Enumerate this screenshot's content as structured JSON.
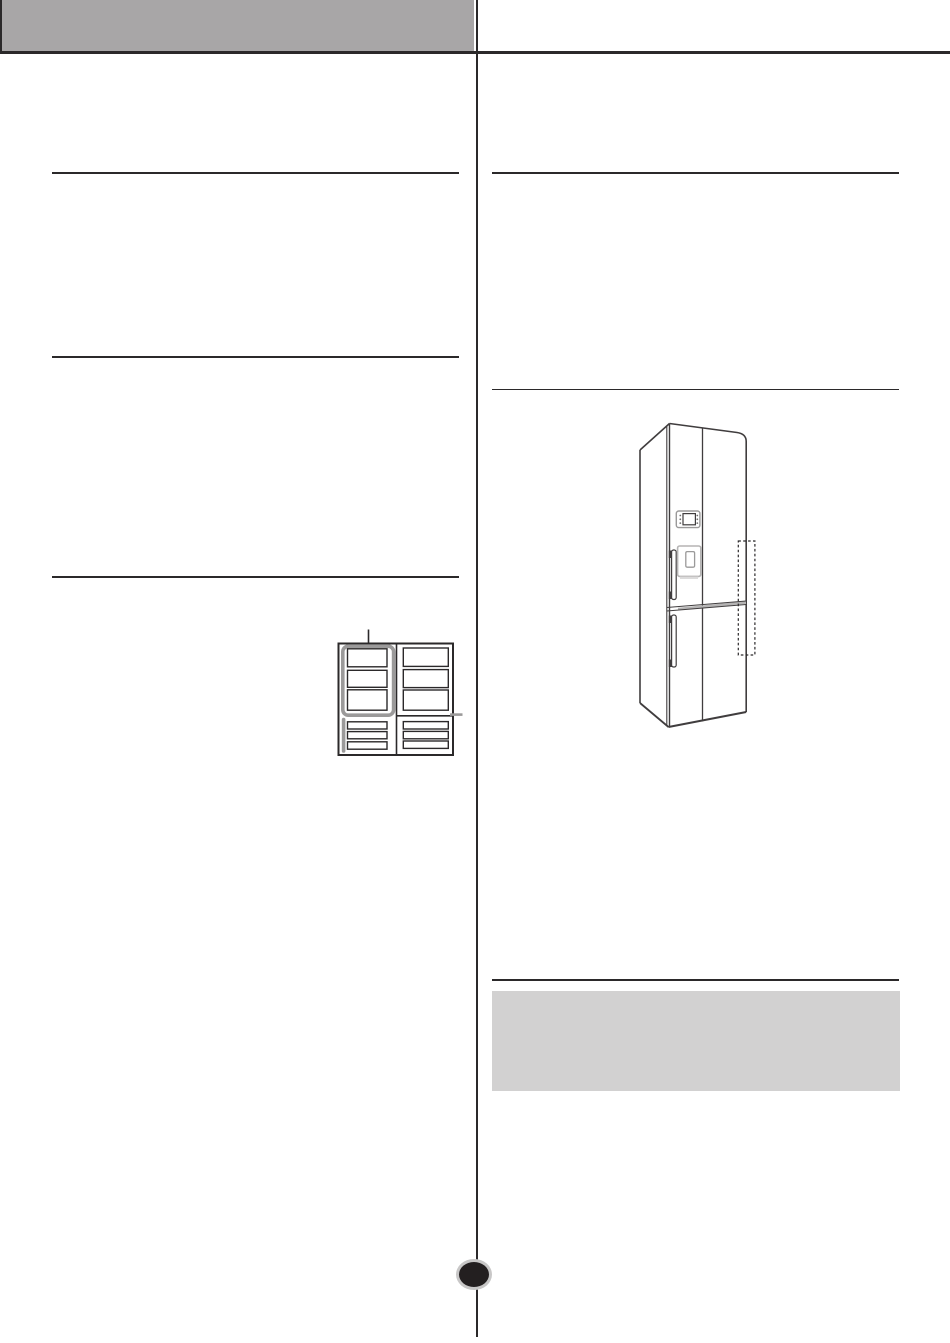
{
  "document": {
    "visible_text": "",
    "description": "scanned manual page, graphics only"
  },
  "colors": {
    "page-bg": "#ffffff",
    "header-bar": "#a8a6a7",
    "rule-dark": "#2b292a",
    "line-art": "#403d3e",
    "line-art-light": "#b5b4b4",
    "highlight-gray": "#9b9a9a",
    "note-box": "#d2d1d1",
    "page-dot-fill": "#231f20",
    "page-dot-ring": "#c8c7c7"
  },
  "figures": {
    "freezer_diagram": {
      "name": "freezer-compartment-grid-diagram",
      "top_left_shelves": 3,
      "top_right_shelves": 3,
      "bottom_left_drawers": 3,
      "bottom_right_drawers": 3,
      "highlighted_section": "top-left",
      "pointer_line": true
    },
    "refrigerator": {
      "name": "bottom-freezer-refrigerator-front-view",
      "features": [
        "control-panel",
        "dispenser",
        "upper-door-handle",
        "lower-door-handle",
        "middle-divider-band",
        "dashed-highlight-right-edge"
      ]
    }
  }
}
